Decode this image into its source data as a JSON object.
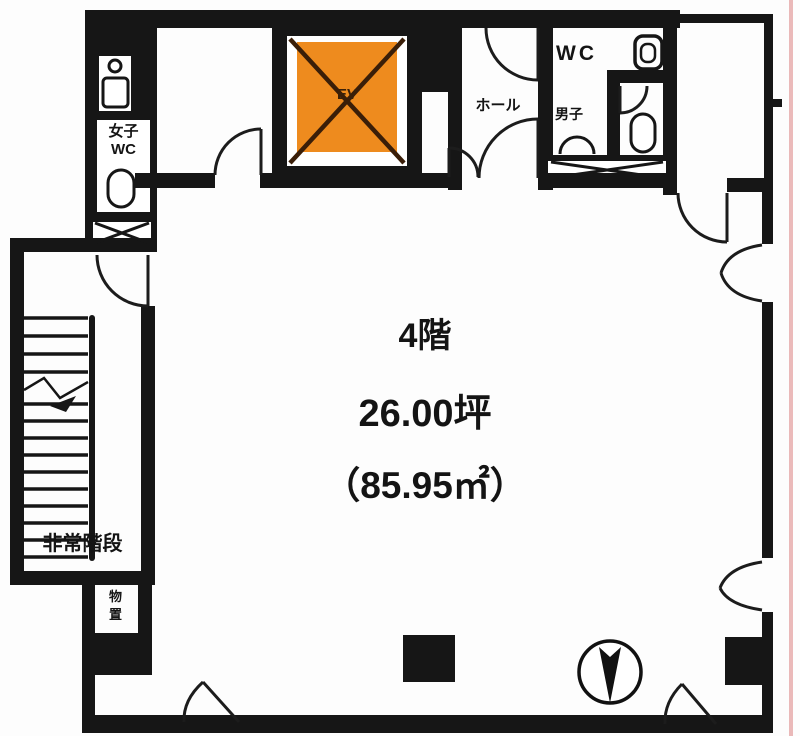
{
  "title": "4階 平面図",
  "unit_info": {
    "floor": "4階",
    "area_tsubo": "26.00坪",
    "area_m2": "（85.95㎡）"
  },
  "rooms": {
    "elevator": "EV",
    "hall": "ホール",
    "wc": "WC",
    "mens": "男子",
    "womens_wc": "女子\nWC",
    "emergency_stairs": "非常階段",
    "storage": "物\n置"
  },
  "icons": {
    "compass": "north-arrow-pointing-down",
    "elevator_shaft": "crossed-box",
    "pipe_shafts": "x-hatched-box"
  },
  "colors": {
    "wall": "#161616",
    "elevator_fill": "#ee8b1e",
    "elevator_cross": "#3a1e08",
    "boundary_line": "#eab9b9",
    "background": "#fdfdfd"
  }
}
